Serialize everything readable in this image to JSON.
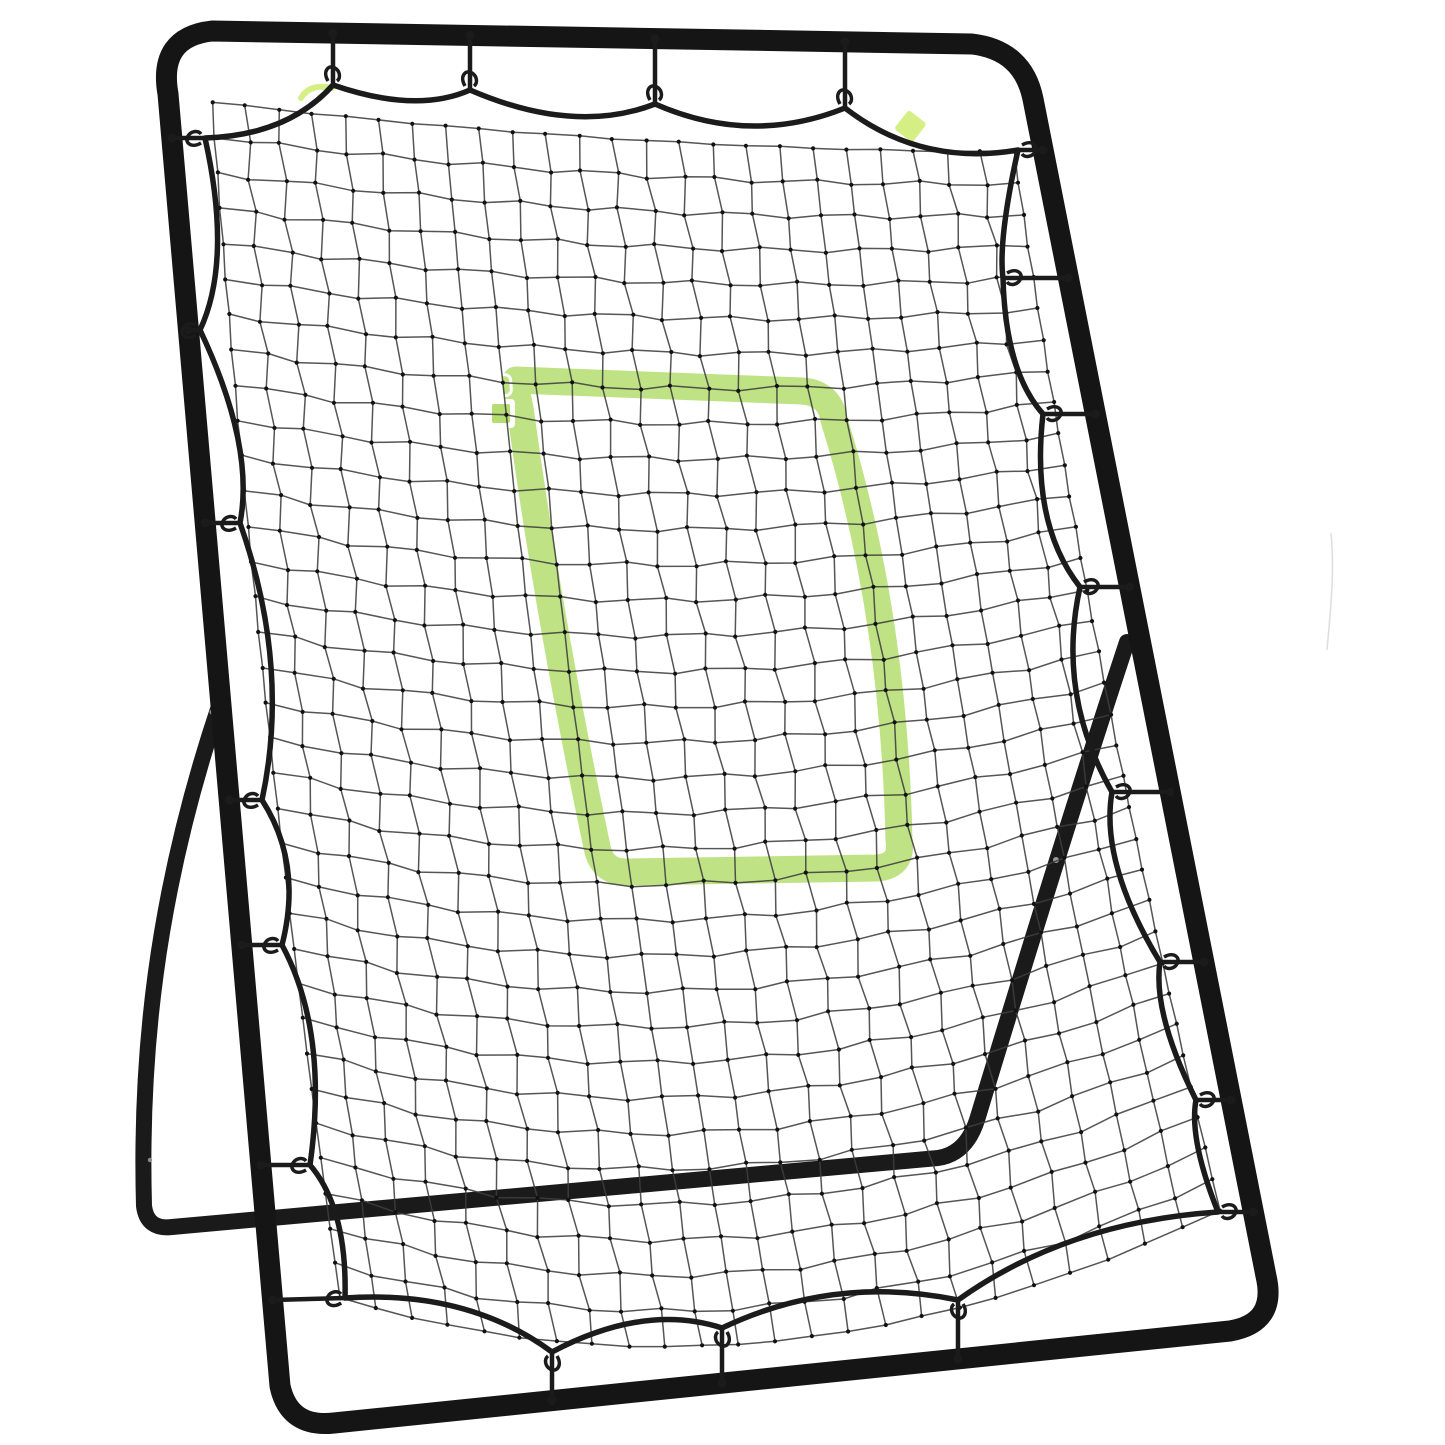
{
  "scene": {
    "subject": "baseball-softball-rebounder-pitchback-net",
    "description": "Black steel A-frame rebounder with black bungee-corded netting and a green strike-zone target band",
    "background_color": "#ffffff"
  },
  "colors": {
    "frame": "#151515",
    "support_legs": "#1a1a1a",
    "net_line": "#3e3e3e",
    "net_knot": "#111111",
    "border_rope": "#1b1b1b",
    "target_green": "#bce27f",
    "target_green_fill": "#b5dd72",
    "tag_green": "#d6ef85",
    "marker_white": "#ffffff",
    "bolt_gray": "#8a8a8a",
    "sheen_gray": "#9a9a9a",
    "artifact_gray": "#cbcbcb"
  },
  "structure": {
    "net_columns": 24,
    "net_rows": 34,
    "bungee_tie_count": 22,
    "top_hook_count": 4,
    "target_shape": "rounded-rectangle",
    "corner_marker_count": 2,
    "green_tag_count": 2
  }
}
